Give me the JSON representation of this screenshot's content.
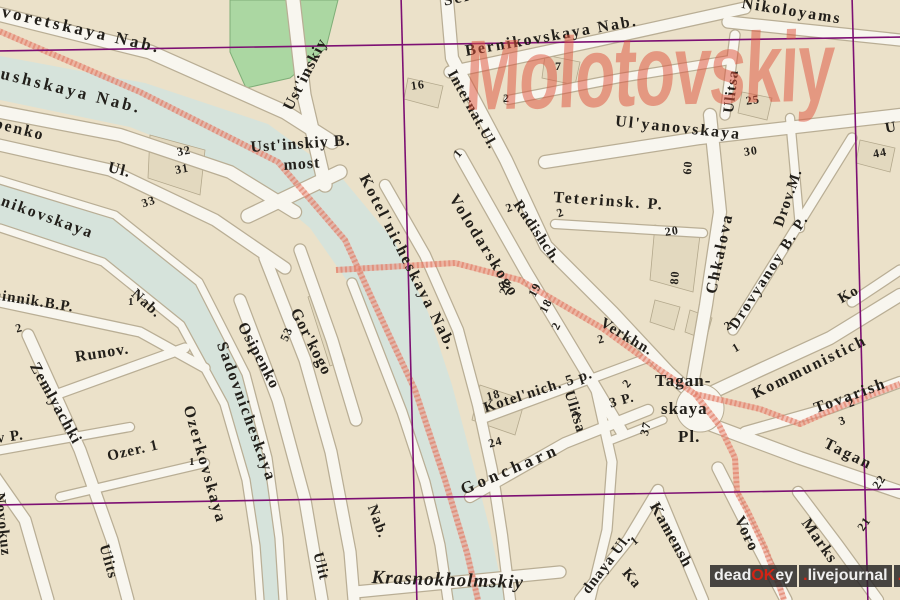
{
  "map": {
    "watermark_title": "Molotovskiy",
    "credit": {
      "dead": "dead",
      "ok": "OK",
      "ey": "ey",
      "dot1": ".",
      "livejournal": "livejournal",
      "dot2": ".",
      "com": "com"
    },
    "colors": {
      "block_tan": "#ebe1c9",
      "road_white": "#f8f6ef",
      "water": "#d6e3db",
      "park_green": "#abd7a2",
      "grid_purple": "#7d1073",
      "route_red": "#ec9383",
      "label_ink": "#221f1a",
      "watermark_red": "#dd4f39",
      "credit_bg": "#2a2828",
      "credit_accent": "#d42314"
    },
    "labels": [
      {
        "t": "kvoretskaya  Nab.",
        "x": -8,
        "y": 0,
        "r": 13,
        "s": 17,
        "ls": 3
      },
      {
        "t": "aushskaya  Nab.",
        "x": -8,
        "y": 62,
        "r": 14,
        "s": 17,
        "ls": 3
      },
      {
        "t": "penko",
        "x": -4,
        "y": 116,
        "r": 14,
        "s": 16,
        "ls": 2
      },
      {
        "t": "Ul.",
        "x": 110,
        "y": 160,
        "r": 14,
        "s": 16
      },
      {
        "t": "Ust'inskiy",
        "x": 281,
        "y": 106,
        "r": -63,
        "s": 16,
        "ls": 1
      },
      {
        "t": "Ust'inskiy B.",
        "x": 250,
        "y": 140,
        "r": -4,
        "s": 16,
        "ls": 1
      },
      {
        "t": "most",
        "x": 283,
        "y": 158,
        "r": -4,
        "s": 16
      },
      {
        "t": "Serebry",
        "x": 442,
        "y": -6,
        "r": -12,
        "s": 16,
        "ls": 2
      },
      {
        "t": "Bernikovskaya  Nab.",
        "x": 464,
        "y": 44,
        "r": -10,
        "s": 16,
        "ls": 2
      },
      {
        "t": "Nikoloyams",
        "x": 743,
        "y": -4,
        "r": 9,
        "s": 16,
        "ls": 2
      },
      {
        "t": "Ulitsa",
        "x": 722,
        "y": 112,
        "r": -83,
        "s": 15,
        "ls": 1
      },
      {
        "t": "Ul'yanovskaya",
        "x": 616,
        "y": 114,
        "r": 6,
        "s": 16,
        "ls": 2
      },
      {
        "t": "U",
        "x": 884,
        "y": 122,
        "r": -10,
        "s": 15
      },
      {
        "t": "44",
        "x": 872,
        "y": 148,
        "r": -10,
        "s": 12
      },
      {
        "t": "25",
        "x": 745,
        "y": 95,
        "r": -8,
        "s": 12
      },
      {
        "t": "30",
        "x": 743,
        "y": 146,
        "r": -8,
        "s": 12
      },
      {
        "t": "60",
        "x": 681,
        "y": 174,
        "r": -86,
        "s": 12
      },
      {
        "t": "16",
        "x": 410,
        "y": 80,
        "r": -8,
        "s": 12
      },
      {
        "t": "7",
        "x": 555,
        "y": 60,
        "r": 0,
        "s": 12
      },
      {
        "t": "2",
        "x": 503,
        "y": 92,
        "r": 0,
        "s": 12
      },
      {
        "t": "1",
        "x": 451,
        "y": 152,
        "r": -50,
        "s": 12
      },
      {
        "t": "Internat.Ul.",
        "x": 457,
        "y": 68,
        "r": 61,
        "s": 15,
        "ls": 1
      },
      {
        "t": "Radishch.",
        "x": 522,
        "y": 198,
        "r": 56,
        "s": 15,
        "ls": 1
      },
      {
        "t": "Verkhn.",
        "x": 605,
        "y": 316,
        "r": 31,
        "s": 15,
        "ls": 1
      },
      {
        "t": "Volodarskogo",
        "x": 459,
        "y": 192,
        "r": 58,
        "s": 16,
        "ls": 2
      },
      {
        "t": "Teterinsk. P.",
        "x": 554,
        "y": 190,
        "r": 4,
        "s": 16,
        "ls": 2
      },
      {
        "t": "2",
        "x": 504,
        "y": 203,
        "r": -20,
        "s": 12
      },
      {
        "t": "2",
        "x": 555,
        "y": 208,
        "r": -20,
        "s": 12
      },
      {
        "t": "20",
        "x": 664,
        "y": 226,
        "r": -8,
        "s": 12
      },
      {
        "t": "80",
        "x": 668,
        "y": 284,
        "r": -86,
        "s": 12
      },
      {
        "t": "Chkalova",
        "x": 704,
        "y": 292,
        "r": -78,
        "s": 16,
        "ls": 2
      },
      {
        "t": "Drov.M.",
        "x": 772,
        "y": 224,
        "r": -71,
        "s": 15,
        "ls": 1
      },
      {
        "t": "Drovyanoy B. P.",
        "x": 727,
        "y": 324,
        "r": -57,
        "s": 15,
        "ls": 2
      },
      {
        "t": "20",
        "x": 497,
        "y": 292,
        "r": -68,
        "s": 12
      },
      {
        "t": "19",
        "x": 526,
        "y": 293,
        "r": -62,
        "s": 12
      },
      {
        "t": "18",
        "x": 537,
        "y": 309,
        "r": -62,
        "s": 12
      },
      {
        "t": "2",
        "x": 549,
        "y": 326,
        "r": -62,
        "s": 12
      },
      {
        "t": "Kotel'nicheskaya  Nab.",
        "x": 370,
        "y": 172,
        "r": 63,
        "s": 16,
        "ls": 2
      },
      {
        "t": "Kotel'nich. 5 p.",
        "x": 482,
        "y": 402,
        "r": -18,
        "s": 15,
        "ls": 1
      },
      {
        "t": "3 P.",
        "x": 608,
        "y": 398,
        "r": -15,
        "s": 14
      },
      {
        "t": "Ulitsa",
        "x": 575,
        "y": 389,
        "r": 73,
        "s": 15,
        "ls": 1
      },
      {
        "t": "Goncharn",
        "x": 458,
        "y": 482,
        "r": -23,
        "s": 17,
        "ls": 4
      },
      {
        "t": "18",
        "x": 485,
        "y": 391,
        "r": -15,
        "s": 12
      },
      {
        "t": "24",
        "x": 487,
        "y": 438,
        "r": -15,
        "s": 12
      },
      {
        "t": "2",
        "x": 596,
        "y": 334,
        "r": -15,
        "s": 12
      },
      {
        "t": "2",
        "x": 620,
        "y": 382,
        "r": -50,
        "s": 12
      },
      {
        "t": "2",
        "x": 570,
        "y": 414,
        "r": -60,
        "s": 12
      },
      {
        "t": "37",
        "x": 638,
        "y": 434,
        "r": -77,
        "s": 12
      },
      {
        "t": "Tagan-",
        "x": 655,
        "y": 372,
        "r": 0,
        "s": 17
      },
      {
        "t": "skaya",
        "x": 661,
        "y": 400,
        "r": 0,
        "s": 17
      },
      {
        "t": "Pl.",
        "x": 678,
        "y": 428,
        "r": 0,
        "s": 17
      },
      {
        "t": "Kommunistich",
        "x": 750,
        "y": 388,
        "r": -26,
        "s": 16,
        "ls": 2
      },
      {
        "t": "Ko",
        "x": 836,
        "y": 294,
        "r": -30,
        "s": 15
      },
      {
        "t": "Tovarish",
        "x": 812,
        "y": 402,
        "r": -20,
        "s": 16,
        "ls": 2
      },
      {
        "t": "2",
        "x": 846,
        "y": 398,
        "r": -20,
        "s": 12
      },
      {
        "t": "3",
        "x": 837,
        "y": 416,
        "r": -20,
        "s": 12
      },
      {
        "t": "Tagan",
        "x": 828,
        "y": 436,
        "r": 26,
        "s": 16,
        "ls": 2
      },
      {
        "t": "22",
        "x": 870,
        "y": 484,
        "r": -55,
        "s": 12
      },
      {
        "t": "21",
        "x": 855,
        "y": 526,
        "r": -55,
        "s": 12
      },
      {
        "t": "Marks",
        "x": 811,
        "y": 516,
        "r": 55,
        "s": 16,
        "ls": 1
      },
      {
        "t": "Voro",
        "x": 745,
        "y": 514,
        "r": 64,
        "s": 16,
        "ls": 1
      },
      {
        "t": "Kamensh",
        "x": 660,
        "y": 500,
        "r": 61,
        "s": 16,
        "ls": 1
      },
      {
        "t": "Ka",
        "x": 630,
        "y": 566,
        "r": 50,
        "s": 15
      },
      {
        "t": "dnaya Ul.",
        "x": 580,
        "y": 588,
        "r": -53,
        "s": 15,
        "ls": 1
      },
      {
        "t": "1",
        "x": 628,
        "y": 538,
        "r": -40,
        "s": 12
      },
      {
        "t": "Nab.",
        "x": 378,
        "y": 503,
        "r": 70,
        "s": 15
      },
      {
        "t": "Krasnokholmskiy",
        "x": 372,
        "y": 568,
        "r": 2,
        "s": 19,
        "i": 1,
        "ls": 1
      },
      {
        "t": "Gor'kogo",
        "x": 301,
        "y": 306,
        "r": 63,
        "s": 16,
        "ls": 1
      },
      {
        "t": "53",
        "x": 278,
        "y": 338,
        "r": -66,
        "s": 12
      },
      {
        "t": "Osipenko",
        "x": 248,
        "y": 320,
        "r": 62,
        "s": 16,
        "ls": 1
      },
      {
        "t": "Sadovnicheskaya",
        "x": 228,
        "y": 340,
        "r": 70,
        "s": 16,
        "ls": 2
      },
      {
        "t": "Ozerkovskaya",
        "x": 195,
        "y": 404,
        "r": 74,
        "s": 16,
        "ls": 2
      },
      {
        "t": "nnikovskaya",
        "x": -6,
        "y": 190,
        "r": 20,
        "s": 16,
        "ls": 2
      },
      {
        "t": "hinnik.B.P.",
        "x": -6,
        "y": 288,
        "r": 9,
        "s": 15,
        "ls": 1
      },
      {
        "t": "Nab.",
        "x": 138,
        "y": 287,
        "r": 42,
        "s": 15
      },
      {
        "t": "1",
        "x": 128,
        "y": 297,
        "r": 0,
        "s": 11
      },
      {
        "t": "2",
        "x": 14,
        "y": 323,
        "r": -15,
        "s": 12
      },
      {
        "t": "Runov.",
        "x": 74,
        "y": 350,
        "r": -9,
        "s": 16,
        "ls": 1
      },
      {
        "t": "Zemlyachki",
        "x": 40,
        "y": 360,
        "r": 61,
        "s": 16,
        "ls": 1
      },
      {
        "t": "v P.",
        "x": -4,
        "y": 432,
        "r": -8,
        "s": 15
      },
      {
        "t": "Ozer. 1",
        "x": 106,
        "y": 450,
        "r": -13,
        "s": 15,
        "ls": 1
      },
      {
        "t": "1",
        "x": 189,
        "y": 457,
        "r": 0,
        "s": 11
      },
      {
        "t": "32",
        "x": 176,
        "y": 146,
        "r": -10,
        "s": 12
      },
      {
        "t": "31",
        "x": 174,
        "y": 164,
        "r": -10,
        "s": 12
      },
      {
        "t": "33",
        "x": 140,
        "y": 198,
        "r": -18,
        "s": 12
      },
      {
        "t": "Novokuz",
        "x": 6,
        "y": 492,
        "r": 84,
        "s": 15,
        "ls": 1
      },
      {
        "t": "Ulits",
        "x": 110,
        "y": 543,
        "r": 74,
        "s": 15,
        "ls": 1
      },
      {
        "t": "Ulit",
        "x": 324,
        "y": 551,
        "r": 76,
        "s": 15,
        "ls": 1
      },
      {
        "t": "2",
        "x": 722,
        "y": 322,
        "r": -30,
        "s": 12
      },
      {
        "t": "1",
        "x": 730,
        "y": 344,
        "r": -30,
        "s": 12
      }
    ]
  }
}
